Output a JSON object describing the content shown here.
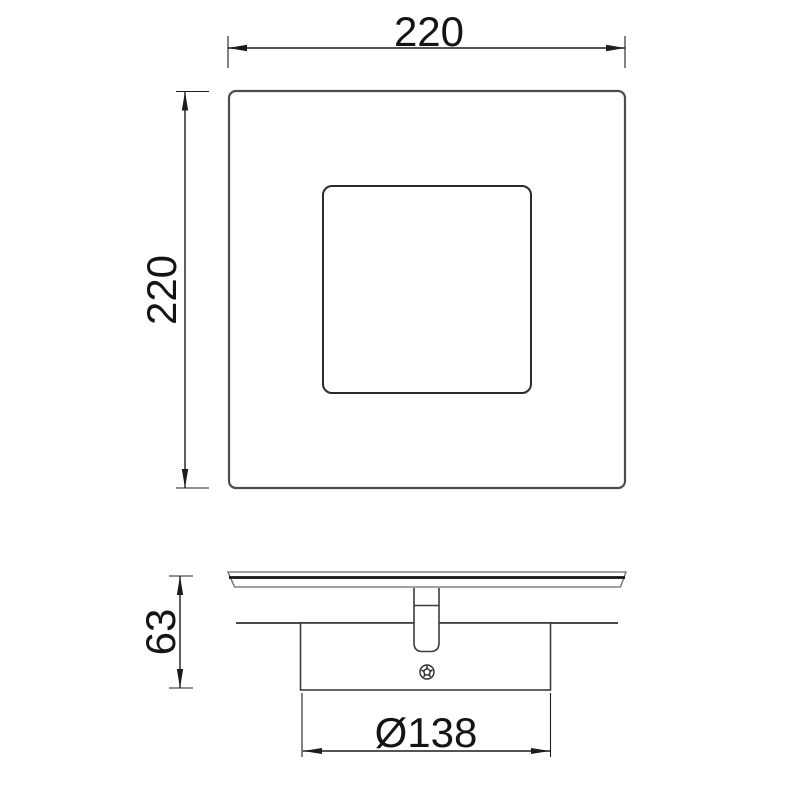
{
  "page": {
    "background": "#ffffff",
    "description_texts": []
  },
  "drawing": {
    "type": "technical-dimension-drawing",
    "dimensions": [
      {
        "id": "top-width",
        "label": "220",
        "orientation": "horizontal",
        "view": "top-view"
      },
      {
        "id": "left-height",
        "label": "220",
        "orientation": "vertical",
        "view": "top-view"
      },
      {
        "id": "side-height",
        "label": "63",
        "orientation": "vertical",
        "view": "side-view"
      },
      {
        "id": "base-diameter",
        "label": "Ø138",
        "orientation": "horizontal",
        "view": "side-view"
      }
    ],
    "colors": {
      "background": "#ffffff",
      "dimension_lines": "#1c1c1c",
      "outline_primary": "#4d4d4d",
      "outline_secondary": "#2b2b2b",
      "text": "#141414"
    }
  }
}
